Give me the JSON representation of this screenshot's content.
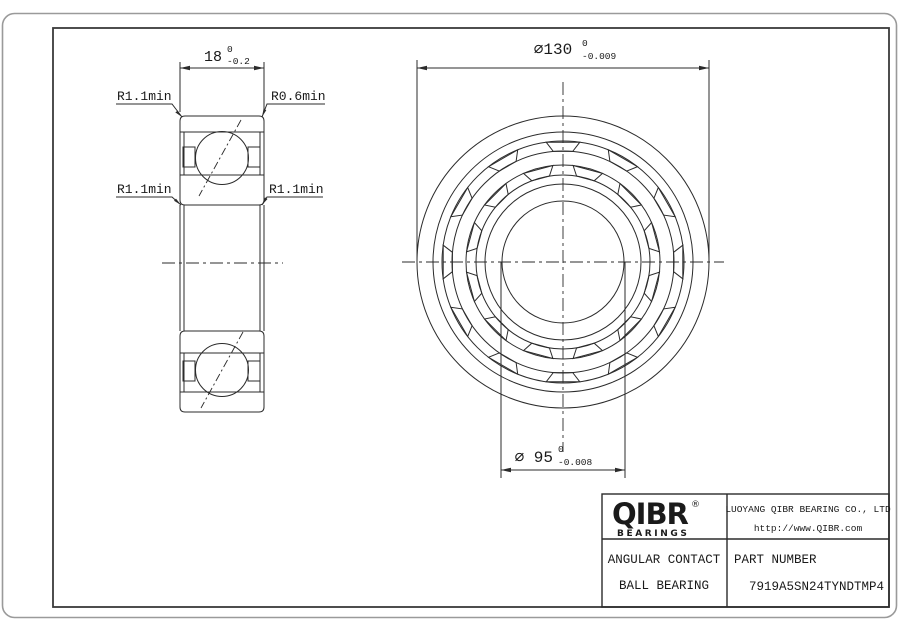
{
  "drawing": {
    "type": "bearing engineering drawing",
    "dimensions": {
      "width": {
        "value": "18",
        "tol_upper": "0",
        "tol_lower": "-0.2"
      },
      "outer_diameter": {
        "value": "⌀130",
        "tol_upper": "0",
        "tol_lower": "-0.009"
      },
      "bore_diameter": {
        "value": "⌀ 95",
        "tol_upper": "0",
        "tol_lower": "-0.008"
      }
    },
    "labels": {
      "radius_top_left": "R1.1min",
      "radius_top_right": "R0.6min",
      "radius_mid_left": "R1.1min",
      "radius_mid_right": "R1.1min"
    }
  },
  "title_block": {
    "logo": {
      "text": "QIBR",
      "registered": "®",
      "subtext": "BEARINGS"
    },
    "company": "LUOYANG QIBR BEARING CO., LTD",
    "website": "http://www.QIBR.com",
    "product_line1": "ANGULAR CONTACT",
    "product_line2": "BALL BEARING",
    "part_number_label": "PART NUMBER",
    "part_number": "7919A5SN24TYNDTMP4"
  },
  "colors": {
    "line": "#2b2b2b",
    "frame": "#3a3a3a",
    "outer_border": "#9a9a9a",
    "background": "#ffffff",
    "text": "#1a1a1a"
  }
}
